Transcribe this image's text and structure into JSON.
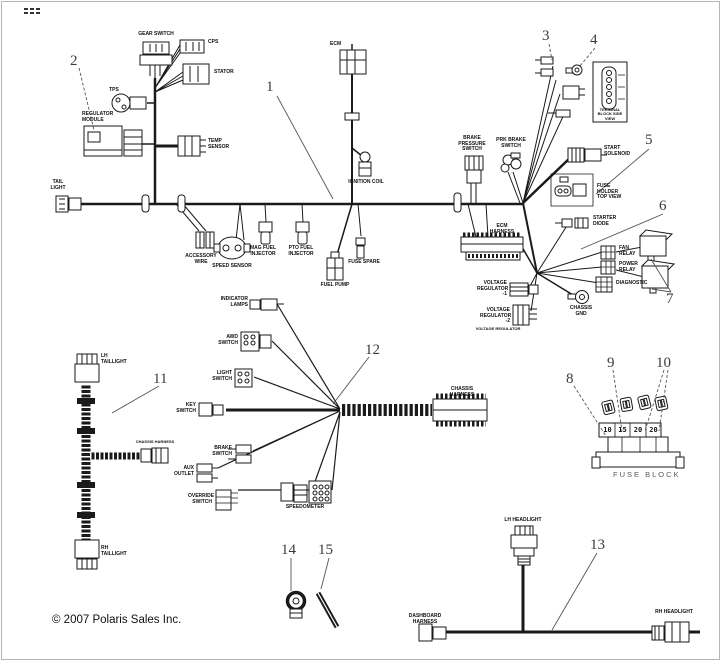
{
  "page": {
    "copyright": "© 2007 Polaris Sales Inc."
  },
  "callouts": {
    "c1": "1",
    "c2": "2",
    "c3": "3",
    "c4": "4",
    "c5": "5",
    "c6": "6",
    "c7": "7",
    "c8": "8",
    "c9": "9",
    "c10": "10",
    "c11": "11",
    "c12": "12",
    "c13": "13",
    "c14": "14",
    "c15": "15"
  },
  "labels": {
    "gear_switch": "GEAR SWITCH",
    "cps": "CPS",
    "stator": "STATOR",
    "tps": "TPS",
    "regulator_module": "REGULATOR MODULE",
    "temp_sensor": "TEMP SENSOR",
    "ecm": "ECM",
    "ignition_coil": "IGNITION COIL",
    "tail_light": "TAIL LIGHT",
    "accessory_wire": "ACCESSORY WIRE",
    "speed_sensor": "SPEED SENSOR",
    "mag_fuel_injector": "MAG FUEL INJECTOR",
    "pto_fuel_injector": "PTO FUEL INJECTOR",
    "fuse_spare": "FUSE SPARE",
    "fuel_pump": "FUEL PUMP",
    "brake_pressure_switch": "BRAKE PRESSURE SWITCH",
    "park_brake_switch": "PRK BRAKE SWITCH",
    "ecm_harness": "ECM HARNESS",
    "terminal_block": "TERMINAL BLOCK SIDE VIEW",
    "start_solenoid": "START SOLENOID",
    "fuse_holder": "FUSE HOLDER TOP VIEW",
    "starter_diode": "STARTER DIODE",
    "fan_relay": "FAN RELAY",
    "power_relay": "POWER RELAY",
    "diagnostic": "DIAGNOSTIC",
    "chassis_ground": "CHASSIS GND",
    "voltage_regulator_1": "VOLTAGE REGULATOR -1",
    "voltage_regulator_2": "VOLTAGE REGULATOR -2",
    "voltage_regulator_note": "VOLTAGE REGULATOR",
    "lh_taillight": "LH TAILLIGHT",
    "rh_taillight": "RH TAILLIGHT",
    "chassis_harness_branch": "CHASSIS HARNESS",
    "chassis_harness_main": "CHASSIS HARNESS",
    "key_switch": "KEY SWITCH",
    "indicator_lamps": "INDICATOR LAMPS",
    "awd_switch": "AWD SWITCH",
    "light_switch": "LIGHT SWITCH",
    "brake_switch": "BRAKE SWITCH",
    "aux_outlet": "AUX OUTLET",
    "override_switch": "OVERRIDE SWITCH",
    "speedometer": "SPEEDOMETER",
    "lh_headlight": "LH HEADLIGHT",
    "rh_headlight": "RH HEADLIGHT",
    "dashboard_harness": "DASHBOARD HARNESS"
  },
  "fuse_block": {
    "title": "FUSE BLOCK",
    "values": [
      "10",
      "15",
      "20",
      "20"
    ]
  }
}
